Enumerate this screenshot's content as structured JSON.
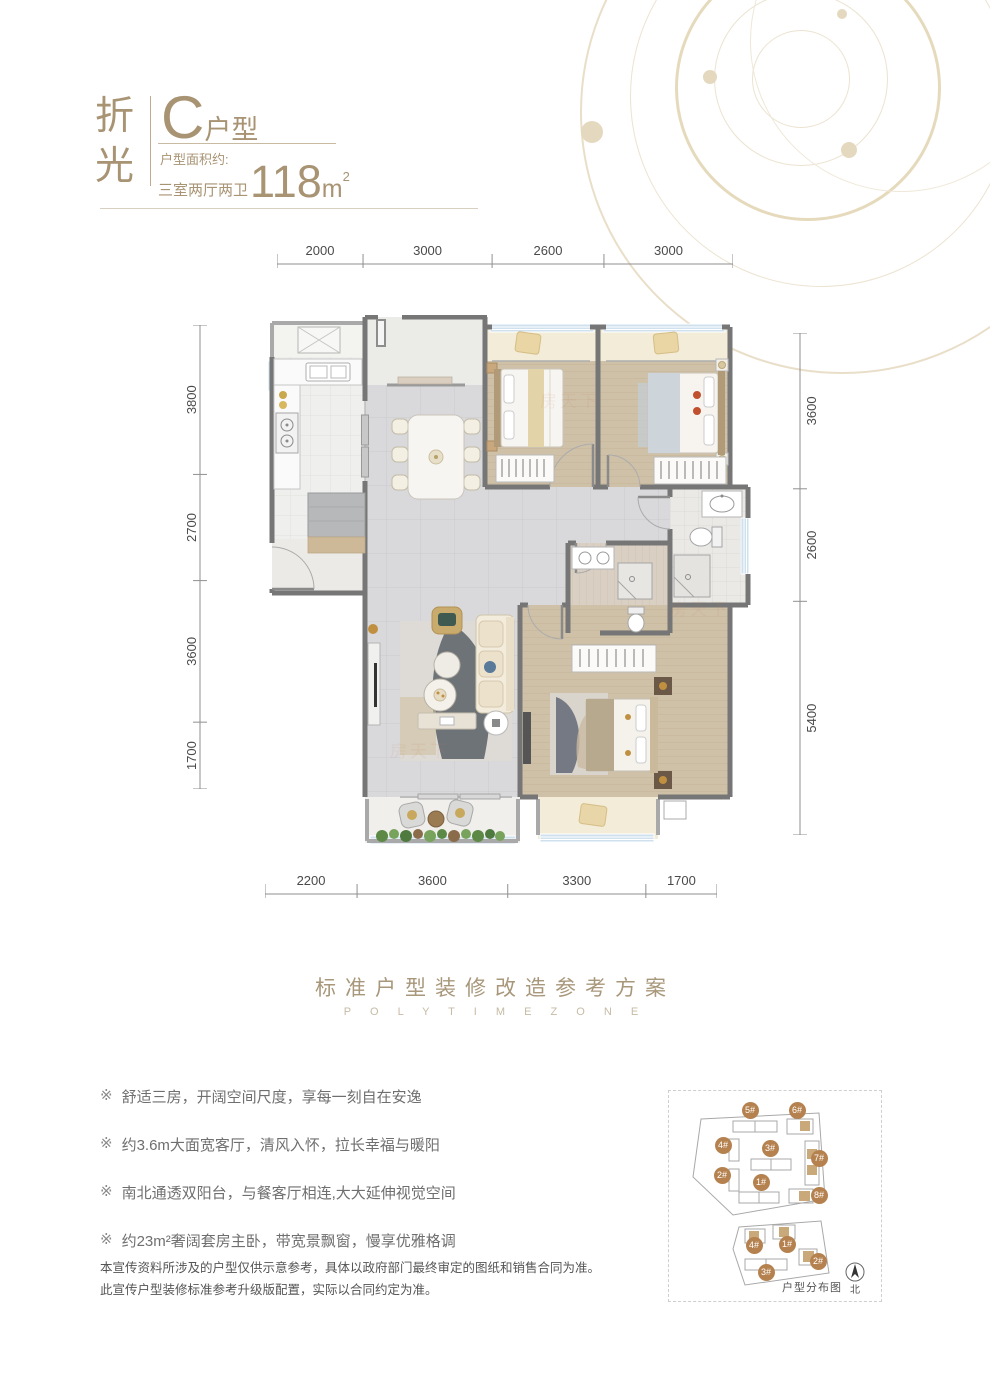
{
  "header": {
    "brand_vertical": "折光",
    "unit_letter": "C",
    "unit_suffix": "户型",
    "area_note": "户型面积约:",
    "layout_label": "三室两厅两卫",
    "area_value": "118",
    "area_unit": "m",
    "area_sup": "2"
  },
  "dimensions": {
    "top": [
      "2000",
      "3000",
      "2600",
      "3000"
    ],
    "bottom": [
      "2200",
      "3600",
      "3300",
      "1700"
    ],
    "left": [
      "3800",
      "2700",
      "3600",
      "1700"
    ],
    "right": [
      "3600",
      "2600",
      "5400"
    ]
  },
  "watermark": "房天下",
  "section_title": {
    "cn": "标准户型装修改造参考方案",
    "en": "P O L Y T I M E Z O N E"
  },
  "feature_marker": "※",
  "features": [
    {
      "text": "舒适三房，开阔空间尺度，享每一刻自在安逸"
    },
    {
      "text": "约3.6m大面宽客厅，清风入怀，拉长幸福与暖阳"
    },
    {
      "text": "南北通透双阳台，与餐客厅相连,大大延伸视觉空间"
    },
    {
      "text": "约23m²奢阔套房主卧，带宽景飘窗，慢享优雅格调"
    }
  ],
  "disclaimer": [
    "本宣传资料所涉及的户型仅供示意参考，具体以政府部门最终审定的图纸和销售合同为准。",
    "此宣传户型装修标准参考升级版配置，实际以合同约定为准。"
  ],
  "site_plan": {
    "label": "户型分布图",
    "north_label": "北",
    "badges": [
      {
        "label": "5#",
        "x": 81,
        "y": 19
      },
      {
        "label": "6#",
        "x": 128,
        "y": 19
      },
      {
        "label": "4#",
        "x": 54,
        "y": 54
      },
      {
        "label": "3#",
        "x": 101,
        "y": 57
      },
      {
        "label": "7#",
        "x": 150,
        "y": 67
      },
      {
        "label": "2#",
        "x": 53,
        "y": 84
      },
      {
        "label": "1#",
        "x": 92,
        "y": 91
      },
      {
        "label": "8#",
        "x": 150,
        "y": 104
      },
      {
        "label": "4#",
        "x": 85,
        "y": 154
      },
      {
        "label": "1#",
        "x": 118,
        "y": 153
      },
      {
        "label": "2#",
        "x": 149,
        "y": 170
      },
      {
        "label": "3#",
        "x": 97,
        "y": 181
      }
    ]
  },
  "colors": {
    "accent_gold": "#a89373",
    "dimension_text": "#4a4a4a",
    "badge": "#b5824f",
    "wall": "#767676"
  }
}
